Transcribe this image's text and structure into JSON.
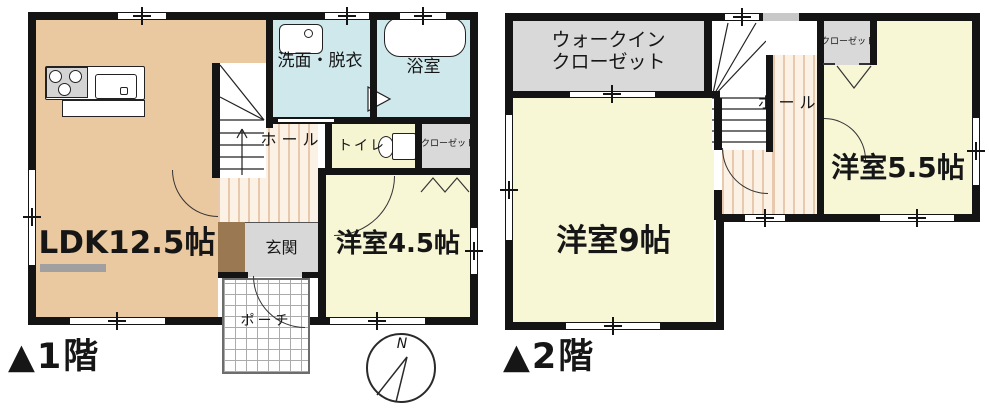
{
  "floor1": {
    "floor_label": "▲1階",
    "rooms": {
      "ldk": "LDK12.5帖",
      "washroom": "洗面・脱衣",
      "bathroom": "浴室",
      "hall": "ホール",
      "toilet": "トイレ",
      "closet": "クローゼット",
      "western_room": "洋室4.5帖",
      "entrance": "玄関",
      "porch": "ポーチ"
    }
  },
  "floor2": {
    "floor_label": "▲2階",
    "rooms": {
      "walk_in_closet_line1": "ウォークイン",
      "walk_in_closet_line2": "クローゼット",
      "hall": "ホール",
      "closet": "クローゼット",
      "western_room_9": "洋室9帖",
      "western_room_5_5": "洋室5.5帖"
    }
  },
  "compass": {
    "north": "N"
  },
  "colors": {
    "ldk_floor": "#eac9a0",
    "wet_room_floor": "#cfe8ec",
    "western_room_floor": "#f7f7d6",
    "closet_floor": "#d9d9d9",
    "entrance_tile": "#d8d8d8",
    "entrance_step": "#9a7851",
    "wall": "#141414",
    "hall_stripe": "#e9c9ad"
  }
}
